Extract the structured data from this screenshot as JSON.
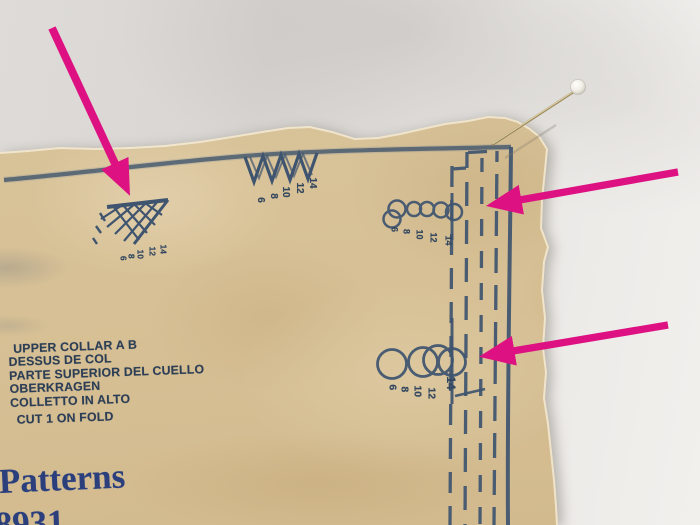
{
  "colors": {
    "background": "#e0ddda",
    "paper": "#d7c197",
    "print_ink": "#3e546f",
    "text_ink": "#2c3e55",
    "brand_ink": "#2b3f7d",
    "arrow": "#de1182",
    "pin_head": "#f6f3ec",
    "pin_shaft": "#9c8a5e"
  },
  "pattern_piece": {
    "piece_name_en": "UPPER COLLAR A B",
    "piece_name_fr": "DESSUS DE COL",
    "piece_name_es": "PARTE SUPERIOR DEL CUELLO",
    "piece_name_de": "OBERKRAGEN",
    "piece_name_it": "COLLETTO IN ALTO",
    "cutting_instruction": "CUT 1 ON FOLD",
    "brand_word": "Patterns",
    "pattern_number": "8931",
    "sizes": [
      "14",
      "12",
      "10",
      "8",
      "6"
    ]
  }
}
